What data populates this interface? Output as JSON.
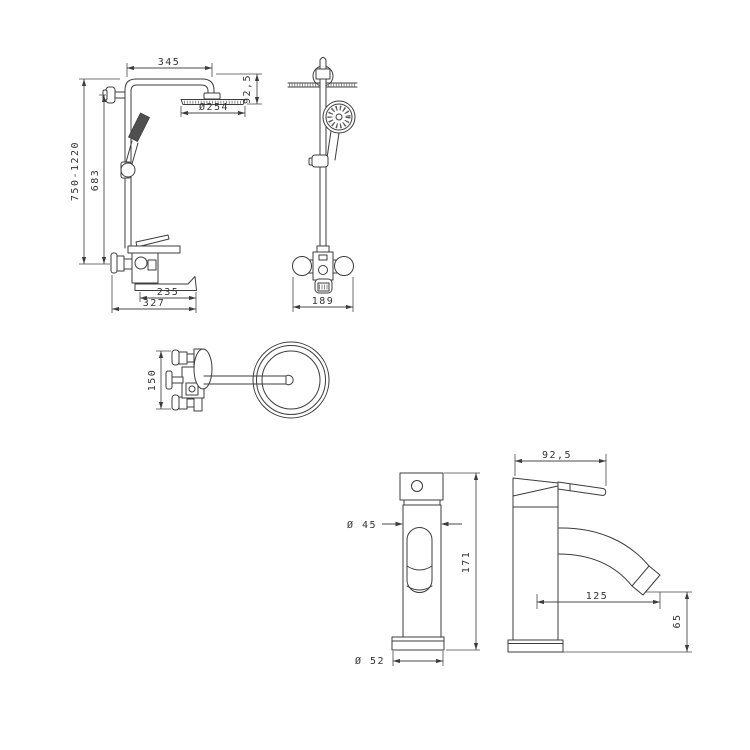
{
  "sheet": {
    "background": "#ffffff",
    "colors": {
      "line": "#3d3d3d",
      "dimension": "#4a4a4a",
      "text": "#333333",
      "dark_fill": "#4f4f4f"
    }
  },
  "views": {
    "shower_side": {
      "arm_length": "345",
      "head_offset": "92,5",
      "head_diameter": "Ø254",
      "total_height": "750-1220",
      "rail_height": "683",
      "spout_length": "235",
      "overall_depth": "327"
    },
    "shower_front": {
      "valve_width": "189"
    },
    "mixer_top": {
      "union_spacing": "150"
    },
    "faucet_front": {
      "body_diameter": "Ø 45",
      "height": "171",
      "base_diameter": "Ø 52"
    },
    "faucet_side": {
      "handle_reach": "92,5",
      "spout_reach": "125",
      "spout_height": "65"
    }
  }
}
